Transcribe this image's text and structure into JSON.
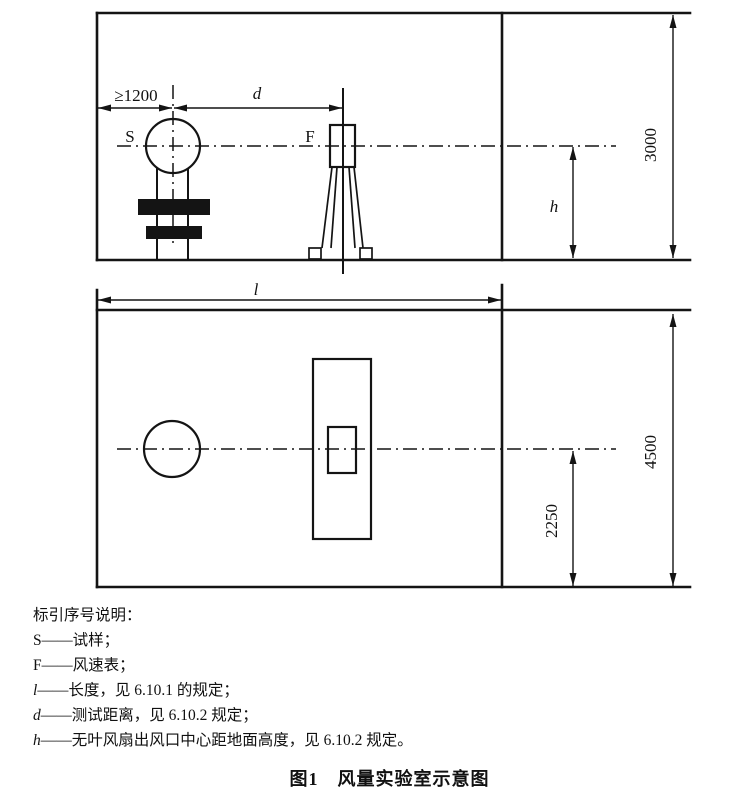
{
  "diagram": {
    "elevation": {
      "sample_label": "S",
      "anemometer_label": "F",
      "dim_min_distance": "≥1200",
      "dim_test_distance": "d",
      "dim_outlet_height": "h",
      "dim_room_height": "3000"
    },
    "plan": {
      "dim_room_length": "l",
      "dim_center_offset": "2250",
      "dim_room_width": "4500"
    }
  },
  "legend": {
    "title": "标引序号说明：",
    "items": [
      {
        "symbol": "S",
        "desc": "——试样；"
      },
      {
        "symbol": "F",
        "desc": "——风速表；"
      },
      {
        "symbol": "l",
        "desc": "——长度，见 6.10.1 的规定；"
      },
      {
        "symbol": "d",
        "desc": "——测试距离，见 6.10.2 规定；"
      },
      {
        "symbol": "h",
        "desc": "——无叶风扇出风口中心距地面高度，见 6.10.2 规定。"
      }
    ]
  },
  "caption": "图1　风量实验室示意图"
}
